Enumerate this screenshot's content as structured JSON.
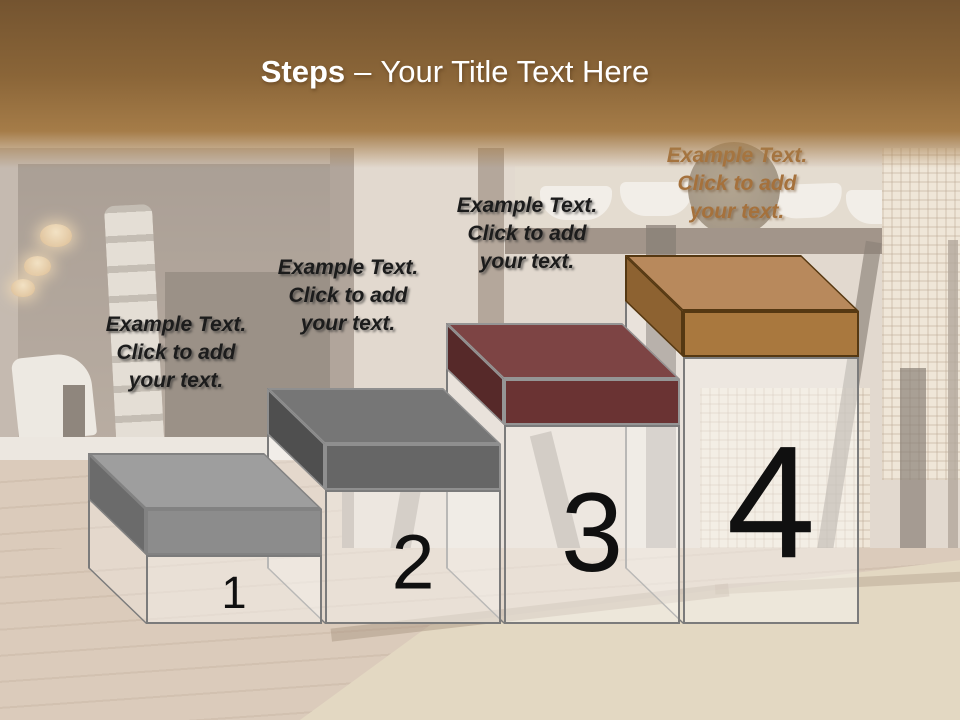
{
  "slide": {
    "title": {
      "keyword": "Steps",
      "separator": "–",
      "text": "Your Title Text Here",
      "color": "#ffffff"
    },
    "header_colors": {
      "top": "#745430",
      "middle": "#8a6538",
      "bottom": "#a57c48"
    },
    "pedestal": {
      "outline": "#7b7b7b",
      "fill": "rgba(248,245,242,0.5)",
      "side_fill": "rgba(255,255,255,0.25)",
      "number_color": "#101010"
    },
    "background": {
      "scene": "washed-out dining room photo"
    }
  },
  "steps": [
    {
      "number": "1",
      "label": "Example Text.\nClick  to add\nyour text.",
      "colors": {
        "top": "#9e9e9e",
        "front": "#8c8c8c",
        "side": "#6b6b6b",
        "outline": "#828282",
        "label": "#1c1c1c",
        "label_shadow": "rgba(40,40,40,0.55)"
      },
      "layout": {
        "x": 146,
        "top": 555,
        "label_x": 176,
        "label_y": 311,
        "num_size": 45
      }
    },
    {
      "number": "2",
      "label": "Example Text.\nClick  to add\nyour text.",
      "colors": {
        "top": "#767676",
        "front": "#666666",
        "side": "#4f4f4f",
        "outline": "#8f8f8f",
        "label": "#1c1c1c",
        "label_shadow": "rgba(40,40,40,0.55)"
      },
      "layout": {
        "x": 325,
        "top": 490,
        "label_x": 348,
        "label_y": 254,
        "num_size": 77
      }
    },
    {
      "number": "3",
      "label": "Example Text.\nClick  to add\nyour text.",
      "colors": {
        "top": "#7d4444",
        "front": "#6a3333",
        "side": "#562929",
        "outline": "#959595",
        "label": "#1c1c1c",
        "label_shadow": "rgba(40,40,40,0.55)"
      },
      "layout": {
        "x": 504,
        "top": 425,
        "label_x": 527,
        "label_y": 192,
        "num_size": 112
      }
    },
    {
      "number": "4",
      "label": "Example Text.\nClick  to add\nyour text.",
      "colors": {
        "top": "#b8895c",
        "front": "#a9783e",
        "side": "#8d6231",
        "outline": "#553812",
        "label": "#a5713c",
        "label_shadow": "rgba(110,75,40,0.45)"
      },
      "layout": {
        "x": 683,
        "top": 357,
        "label_x": 737,
        "label_y": 142,
        "num_size": 160
      }
    }
  ]
}
